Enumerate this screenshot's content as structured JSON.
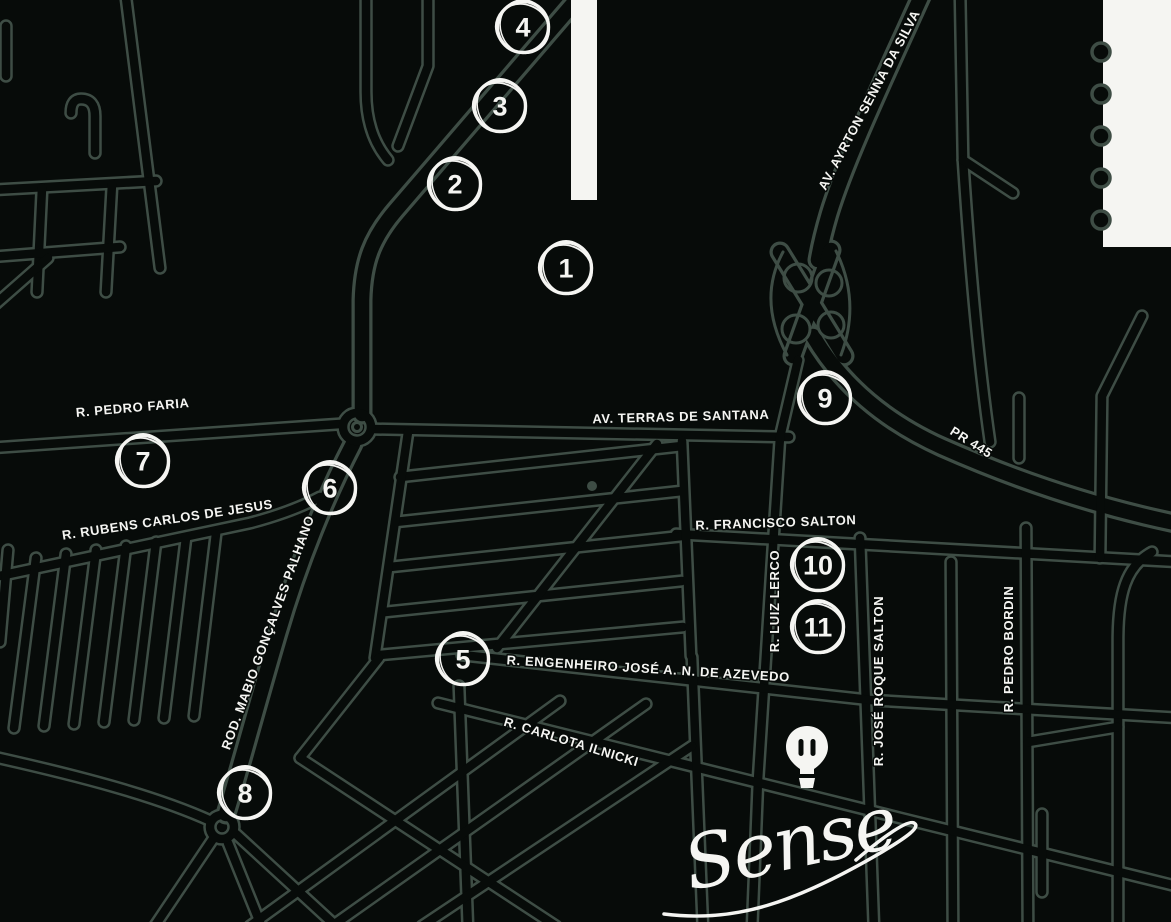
{
  "map": {
    "colors": {
      "background": "#070b09",
      "road": "#3e4d45",
      "label": "#f5f5f2"
    },
    "street_labels": [
      "R. PEDRO FARIA",
      "R. RUBENS CARLOS DE JESUS",
      "AV. TERRAS DE SANTANA",
      "AV. AYRTON SENNA DA SILVA",
      "PR 445",
      "R. FRANCISCO SALTON",
      "R. LUIZ LERCO",
      "R. JOSÉ ROQUE SALTON",
      "R. PEDRO BORDIN",
      "ROD. MABIO GONÇALVES PALHANO",
      "R. ENGENHEIRO JOSÉ A. N. DE AZEVEDO",
      "R. CARLOTA ILNICKI"
    ],
    "markers": [
      "1",
      "2",
      "3",
      "4",
      "5",
      "6",
      "7",
      "8",
      "9",
      "10",
      "11"
    ],
    "logo": {
      "text": "Sense",
      "icon": "hot-air-balloon-icon"
    }
  }
}
